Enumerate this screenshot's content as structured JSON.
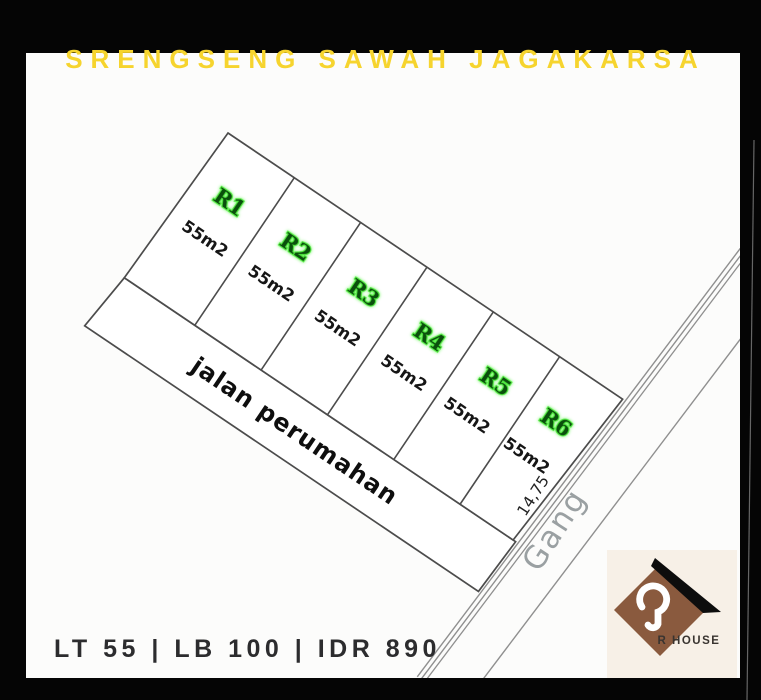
{
  "title": "SRENGSENG SAWAH JAGAKARSA",
  "footer": "LT 55 | LB 100 | IDR 890",
  "plots": [
    {
      "id": "R1",
      "area": "55m2"
    },
    {
      "id": "R2",
      "area": "55m2"
    },
    {
      "id": "R3",
      "area": "55m2"
    },
    {
      "id": "R4",
      "area": "55m2"
    },
    {
      "id": "R5",
      "area": "55m2"
    },
    {
      "id": "R6",
      "area": "55m2"
    }
  ],
  "labels": {
    "road": "jalan perumahan",
    "alley": "Gang",
    "side_dimension": "14,75"
  },
  "logo": {
    "text": "R HOUSE"
  },
  "colors": {
    "title_yellow": "#f6d42e",
    "plot_id_green": "#0a4f0c",
    "plot_id_glow": "#4fe53e",
    "plan_line_dark": "#4c4c4c",
    "alley_line_gray": "#8f8f8f",
    "logo_brown": "#8a5a3e",
    "logo_cream": "#f7f0e7",
    "frame_black": "#050505",
    "footer_text": "#2c2c2e"
  }
}
